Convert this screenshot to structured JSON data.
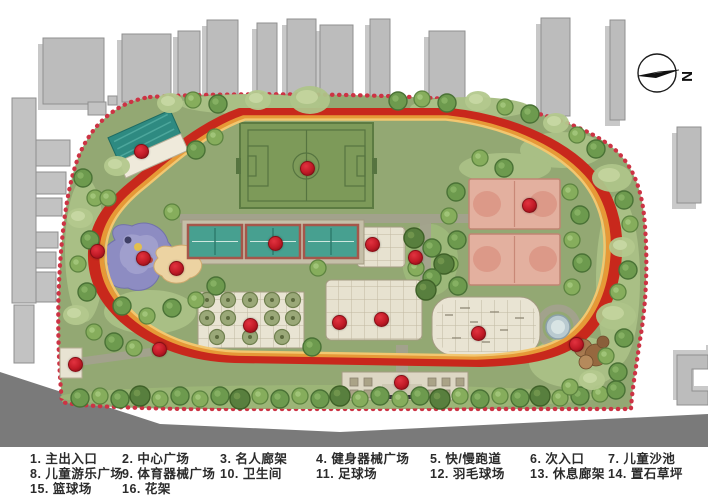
{
  "compass": {
    "label": "N"
  },
  "legend": {
    "items": [
      {
        "row": 0,
        "col": 0,
        "text": "1. 主出入口"
      },
      {
        "row": 0,
        "col": 1,
        "text": "2. 中心广场"
      },
      {
        "row": 0,
        "col": 2,
        "text": "3. 名人廊架"
      },
      {
        "row": 0,
        "col": 3,
        "text": "4. 健身器械广场"
      },
      {
        "row": 0,
        "col": 4,
        "text": "5. 快/慢跑道"
      },
      {
        "row": 0,
        "col": 5,
        "text": "6. 次入口"
      },
      {
        "row": 0,
        "col": 6,
        "text": "7. 儿童沙池"
      },
      {
        "row": 1,
        "col": 0,
        "text": "8. 儿童游乐广场"
      },
      {
        "row": 1,
        "col": 1,
        "text": "9. 体育器械广场"
      },
      {
        "row": 1,
        "col": 2,
        "text": "10. 卫生间"
      },
      {
        "row": 1,
        "col": 3,
        "text": "11. 足球场"
      },
      {
        "row": 1,
        "col": 4,
        "text": "12. 羽毛球场"
      },
      {
        "row": 1,
        "col": 5,
        "text": "13. 休息廊架"
      },
      {
        "row": 1,
        "col": 6,
        "text": "14. 置石草坪"
      },
      {
        "row": 2,
        "col": 0,
        "text": "15. 篮球场"
      },
      {
        "row": 2,
        "col": 1,
        "text": "16. 花架"
      }
    ]
  },
  "markers": [
    {
      "x": 96,
      "y": 250
    },
    {
      "x": 140,
      "y": 150
    },
    {
      "x": 306,
      "y": 167
    },
    {
      "x": 274,
      "y": 242
    },
    {
      "x": 371,
      "y": 243
    },
    {
      "x": 142,
      "y": 257
    },
    {
      "x": 175,
      "y": 267
    },
    {
      "x": 414,
      "y": 256
    },
    {
      "x": 528,
      "y": 204
    },
    {
      "x": 249,
      "y": 324
    },
    {
      "x": 338,
      "y": 321
    },
    {
      "x": 380,
      "y": 318
    },
    {
      "x": 477,
      "y": 332
    },
    {
      "x": 575,
      "y": 343
    },
    {
      "x": 158,
      "y": 348
    },
    {
      "x": 74,
      "y": 363
    },
    {
      "x": 400,
      "y": 381
    }
  ],
  "colors": {
    "track_red": "#c8281c",
    "track_orange": "#e69937",
    "track_yellow": "#f2c770",
    "boundary": "#cc3344",
    "park_green": "#93a873",
    "marker_red": "#c01a26",
    "court_teal": "#47a090",
    "court_pink": "#e3b09f",
    "building_gray": "#bcbcbc"
  }
}
